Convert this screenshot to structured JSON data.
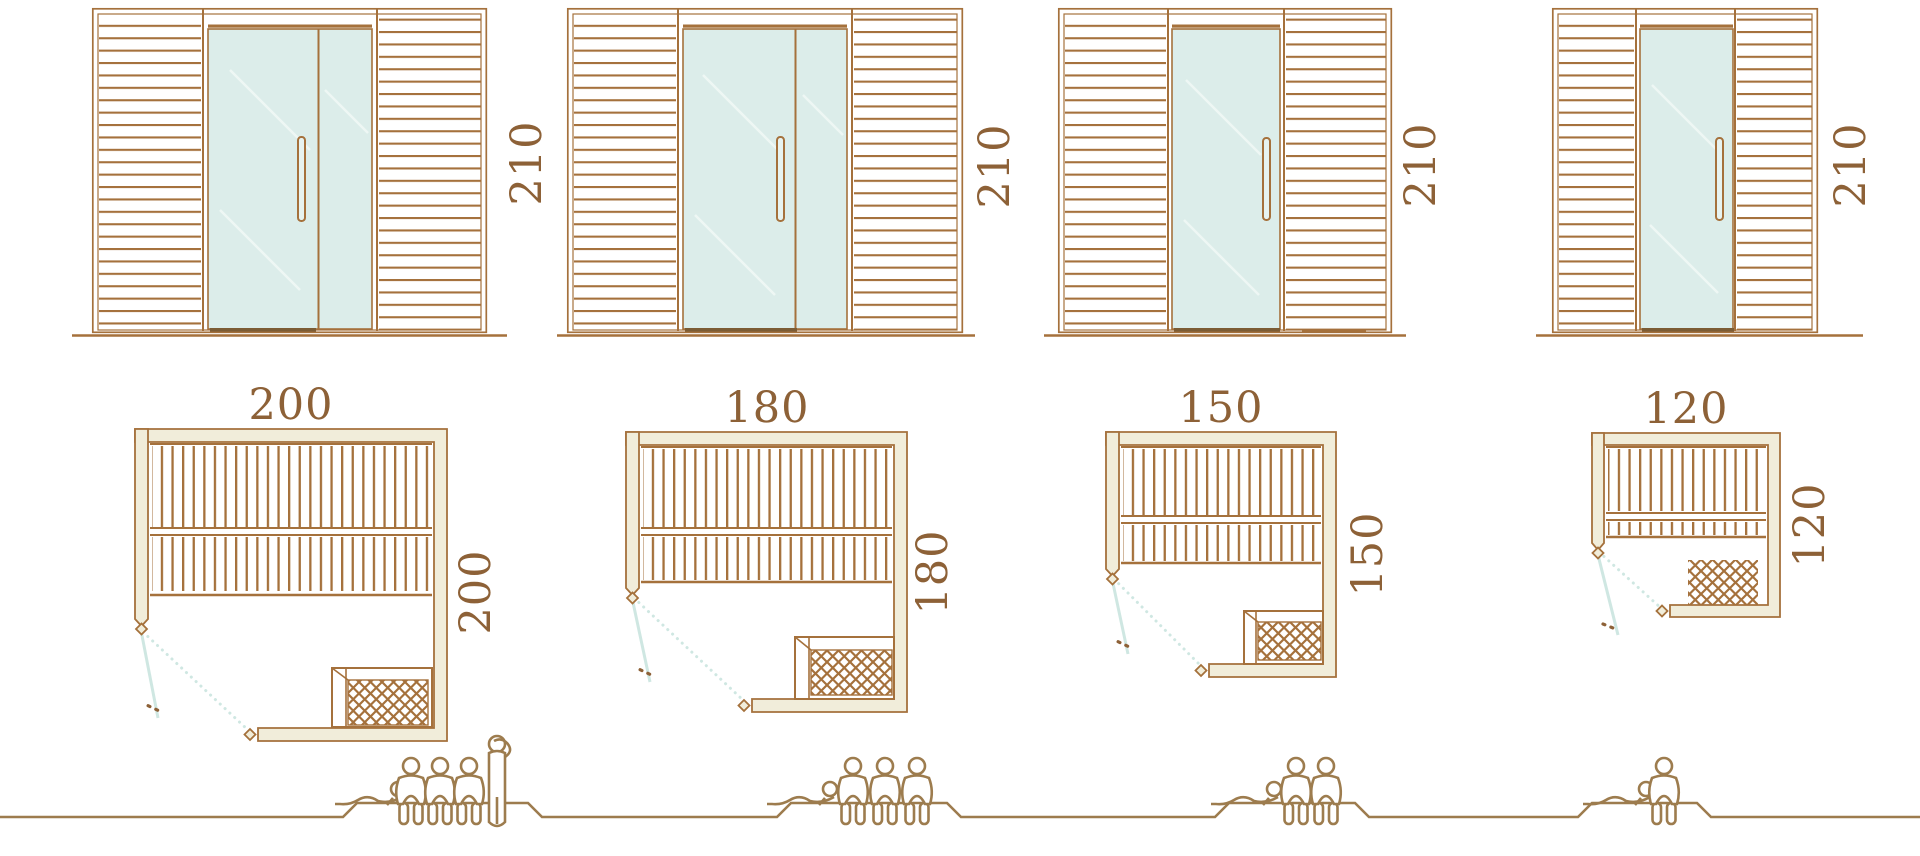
{
  "palette": {
    "line_brown": "#a5713c",
    "text_brown": "#8d6137",
    "wall_fill": "#f1edda",
    "glass_blue": "#dcedea",
    "swing_blue": "#cfe7e2",
    "figure_brown": "#9d7c4e",
    "threshold_brown": "#7b5c35"
  },
  "elevations": [
    {
      "height_label": "210",
      "door": "double-glass"
    },
    {
      "height_label": "210",
      "door": "double-glass"
    },
    {
      "height_label": "210",
      "door": "single-glass"
    },
    {
      "height_label": "210",
      "door": "single-glass"
    }
  ],
  "plans": [
    {
      "width_label": "200",
      "depth_label": "200"
    },
    {
      "width_label": "180",
      "depth_label": "180"
    },
    {
      "width_label": "150",
      "depth_label": "150"
    },
    {
      "width_label": "120",
      "depth_label": "120"
    }
  ],
  "capacity_figures": [
    {
      "cabin": "200",
      "reclining": 1,
      "seated": 3,
      "standing": 1
    },
    {
      "cabin": "180",
      "reclining": 1,
      "seated": 3,
      "standing": 0
    },
    {
      "cabin": "150",
      "reclining": 1,
      "seated": 2,
      "standing": 0
    },
    {
      "cabin": "120",
      "reclining": 1,
      "seated": 1,
      "standing": 0
    }
  ]
}
